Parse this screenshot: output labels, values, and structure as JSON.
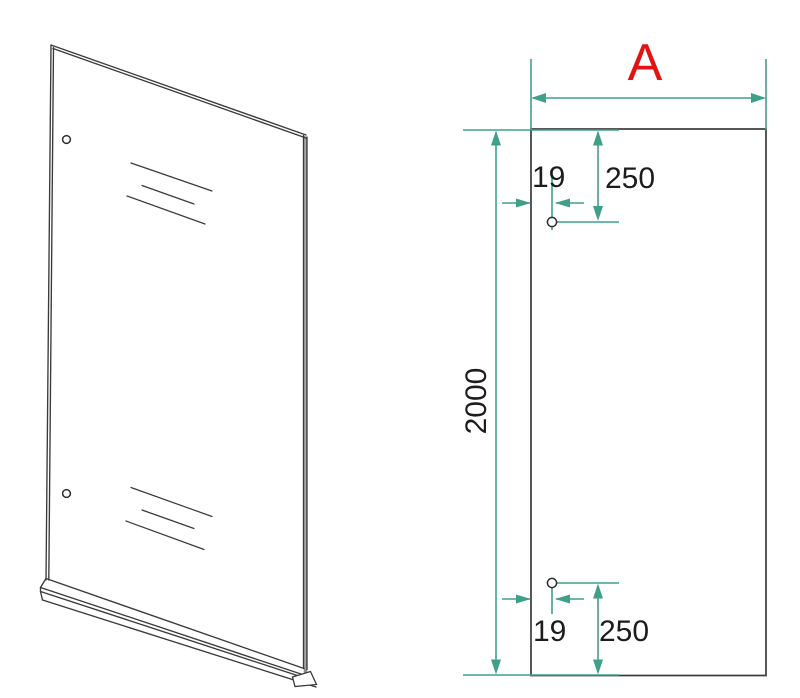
{
  "drawing": {
    "width_label": "A",
    "height_label": "2000",
    "top_hole": {
      "side_offset": "19",
      "vertical_offset": "250"
    },
    "bottom_hole": {
      "side_offset": "19",
      "vertical_offset": "250"
    },
    "colors": {
      "dimension_line": "#3fa08a",
      "outline": "#3a3a3a",
      "label_accent": "#e21313",
      "dimension_text": "#1c1c1c",
      "background": "#ffffff"
    }
  }
}
